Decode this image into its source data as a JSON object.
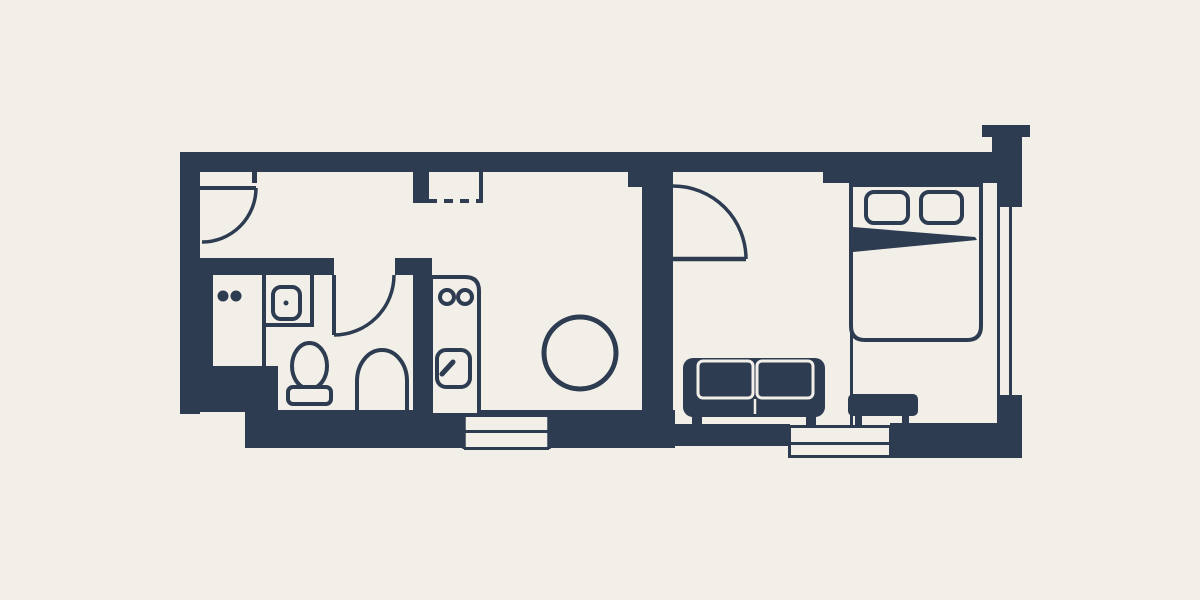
{
  "meta": {
    "title": "studio-apartment-floor-plan",
    "canvas": {
      "width": 1200,
      "height": 600
    }
  },
  "palette": {
    "background": "#f2efe9",
    "wall": "#2d3c50",
    "cream": "#f2efe9"
  },
  "rooms": [
    "entry-hall",
    "bathroom",
    "kitchen",
    "dining-area",
    "living-room",
    "bedroom"
  ],
  "floorplan": {
    "elements": [
      {
        "name": "top-wall",
        "kind": "rect",
        "x": 180,
        "y": 152,
        "w": 842,
        "h": 20,
        "fill": "wall"
      },
      {
        "name": "bedroom-top-wall",
        "kind": "rect",
        "x": 823,
        "y": 152,
        "w": 199,
        "h": 31,
        "fill": "wall"
      },
      {
        "name": "chimney-cap",
        "kind": "rect",
        "x": 982,
        "y": 125,
        "w": 48,
        "h": 12,
        "fill": "wall"
      },
      {
        "name": "chimney-stub",
        "kind": "rect",
        "x": 992,
        "y": 137,
        "w": 30,
        "h": 16,
        "fill": "wall"
      },
      {
        "name": "left-wall",
        "kind": "rect",
        "x": 180,
        "y": 152,
        "w": 20,
        "h": 262,
        "fill": "wall"
      },
      {
        "name": "bathroom-corner-block",
        "kind": "rect",
        "x": 198,
        "y": 366,
        "w": 80,
        "h": 46,
        "fill": "wall"
      },
      {
        "name": "bottom-wall-left",
        "kind": "rect",
        "x": 245,
        "y": 410,
        "w": 430,
        "h": 38,
        "fill": "wall"
      },
      {
        "name": "bottom-wall-living",
        "kind": "rect",
        "x": 660,
        "y": 424,
        "w": 130,
        "h": 22,
        "fill": "wall"
      },
      {
        "name": "bottom-wall-right",
        "kind": "rect",
        "x": 890,
        "y": 423,
        "w": 132,
        "h": 35,
        "fill": "wall"
      },
      {
        "name": "right-wall",
        "kind": "rect",
        "x": 997,
        "y": 152,
        "w": 25,
        "h": 306,
        "fill": "wall"
      },
      {
        "name": "bathroom-top-wall",
        "kind": "rect",
        "x": 198,
        "y": 258,
        "w": 136,
        "h": 17,
        "fill": "wall"
      },
      {
        "name": "bathroom-top-wall-right",
        "kind": "rect",
        "x": 395,
        "y": 258,
        "w": 37,
        "h": 17,
        "fill": "wall"
      },
      {
        "name": "bathroom-kitchen-wall",
        "kind": "rect",
        "x": 413,
        "y": 263,
        "w": 19,
        "h": 150,
        "fill": "wall"
      },
      {
        "name": "bathroom-left-strip",
        "kind": "rect",
        "x": 198,
        "y": 275,
        "w": 15,
        "h": 95,
        "fill": "wall"
      },
      {
        "name": "closet-side-wall",
        "kind": "rect",
        "x": 413,
        "y": 171,
        "w": 16,
        "h": 32,
        "fill": "wall"
      },
      {
        "name": "living-divider-flare",
        "kind": "rect",
        "x": 628,
        "y": 171,
        "w": 45,
        "h": 16,
        "fill": "wall"
      },
      {
        "name": "living-divider-wall",
        "kind": "rect",
        "x": 642,
        "y": 171,
        "w": 31,
        "h": 256,
        "fill": "wall"
      },
      {
        "name": "entry-door-jamb",
        "kind": "rect",
        "x": 252,
        "y": 171,
        "w": 5,
        "h": 12,
        "fill": "wall"
      },
      {
        "name": "kitchen-window-glass",
        "kind": "rect",
        "x": 464,
        "y": 417,
        "w": 85,
        "h": 30,
        "fill": "cream"
      },
      {
        "name": "kitchen-window-mid-line",
        "kind": "line",
        "x1": 464,
        "y1": 431.5,
        "x2": 549,
        "y2": 431.5,
        "stroke": "wall",
        "sw": 3
      },
      {
        "name": "kitchen-window-left-end",
        "kind": "line",
        "x1": 464,
        "y1": 412,
        "x2": 464,
        "y2": 449,
        "stroke": "wall",
        "sw": 3.5
      },
      {
        "name": "kitchen-window-right-end",
        "kind": "line",
        "x1": 549,
        "y1": 412,
        "x2": 549,
        "y2": 449,
        "stroke": "wall",
        "sw": 3.5
      },
      {
        "name": "kitchen-window-bottom-line",
        "kind": "line",
        "x1": 464,
        "y1": 448.5,
        "x2": 549,
        "y2": 448.5,
        "stroke": "wall",
        "sw": 3
      },
      {
        "name": "living-window-glass",
        "kind": "rect",
        "x": 789,
        "y": 427,
        "w": 102,
        "h": 29,
        "fill": "cream"
      },
      {
        "name": "living-window-top-line",
        "kind": "line",
        "x1": 788,
        "y1": 426.5,
        "x2": 892,
        "y2": 426.5,
        "stroke": "wall",
        "sw": 3
      },
      {
        "name": "living-window-mid-line",
        "kind": "line",
        "x1": 788,
        "y1": 443.5,
        "x2": 892,
        "y2": 443.5,
        "stroke": "wall",
        "sw": 3
      },
      {
        "name": "living-window-bottom-line",
        "kind": "line",
        "x1": 788,
        "y1": 456.5,
        "x2": 892,
        "y2": 456.5,
        "stroke": "wall",
        "sw": 3
      },
      {
        "name": "living-window-left-end",
        "kind": "line",
        "x1": 789.5,
        "y1": 425,
        "x2": 789.5,
        "y2": 458,
        "stroke": "wall",
        "sw": 3
      },
      {
        "name": "living-window-right-end",
        "kind": "line",
        "x1": 890.5,
        "y1": 425,
        "x2": 890.5,
        "y2": 458,
        "stroke": "wall",
        "sw": 3
      },
      {
        "name": "right-window-glass",
        "kind": "rect",
        "x": 1000,
        "y": 207,
        "w": 22,
        "h": 188,
        "fill": "cream"
      },
      {
        "name": "right-window-mid-line",
        "kind": "line",
        "x1": 1010.5,
        "y1": 207,
        "x2": 1010.5,
        "y2": 395,
        "stroke": "wall",
        "sw": 3
      },
      {
        "name": "entry-door-leaf",
        "kind": "line",
        "x1": 200,
        "y1": 188,
        "x2": 256,
        "y2": 188,
        "stroke": "wall",
        "sw": 4
      },
      {
        "name": "entry-door-arc",
        "kind": "path",
        "d": "M256,188 A54,54 0 0 1 202,242",
        "stroke": "wall",
        "sw": 3.5,
        "fill": "none"
      },
      {
        "name": "bathroom-door-leaf",
        "kind": "line",
        "x1": 334,
        "y1": 275,
        "x2": 334,
        "y2": 335,
        "stroke": "wall",
        "sw": 4
      },
      {
        "name": "bathroom-door-arc",
        "kind": "path",
        "d": "M394,275 A60,60 0 0 1 334,335",
        "stroke": "wall",
        "sw": 3.5,
        "fill": "none"
      },
      {
        "name": "living-door-leaf",
        "kind": "line",
        "x1": 673,
        "y1": 259,
        "x2": 746,
        "y2": 259,
        "stroke": "wall",
        "sw": 4.5
      },
      {
        "name": "living-door-arc",
        "kind": "path",
        "d": "M746,259 A73,73 0 0 0 673,186",
        "stroke": "wall",
        "sw": 3.5,
        "fill": "none"
      },
      {
        "name": "closet-right-line",
        "kind": "line",
        "x1": 481,
        "y1": 172,
        "x2": 481,
        "y2": 202,
        "stroke": "wall",
        "sw": 4
      },
      {
        "name": "closet-dashed-front",
        "kind": "line",
        "x1": 428,
        "y1": 201,
        "x2": 483,
        "y2": 201,
        "stroke": "wall",
        "sw": 4,
        "dash": "9 7"
      },
      {
        "name": "counter-burner-dot-1",
        "kind": "circle",
        "cx": 223,
        "cy": 296,
        "r": 5.5,
        "fill": "wall"
      },
      {
        "name": "counter-burner-dot-2",
        "kind": "circle",
        "cx": 236,
        "cy": 296,
        "r": 5.5,
        "fill": "wall"
      },
      {
        "name": "cabinet-divider-line",
        "kind": "line",
        "x1": 264,
        "y1": 275,
        "x2": 264,
        "y2": 368,
        "stroke": "wall",
        "sw": 4
      },
      {
        "name": "sink-counter-bottom-line",
        "kind": "line",
        "x1": 262,
        "y1": 325,
        "x2": 314,
        "y2": 325,
        "stroke": "wall",
        "sw": 4
      },
      {
        "name": "sink-counter-right-line",
        "kind": "line",
        "x1": 312,
        "y1": 262,
        "x2": 312,
        "y2": 327,
        "stroke": "wall",
        "sw": 4
      },
      {
        "name": "bathroom-sink-basin",
        "kind": "rect",
        "x": 273,
        "y": 287,
        "w": 27,
        "h": 32,
        "rx": 8,
        "stroke": "wall",
        "sw": 4,
        "fill": "cream"
      },
      {
        "name": "bathroom-sink-drain",
        "kind": "circle",
        "cx": 286,
        "cy": 303,
        "r": 2.5,
        "fill": "wall"
      },
      {
        "name": "toilet-bowl",
        "kind": "ellipse",
        "cx": 309.5,
        "cy": 366,
        "rx": 17.5,
        "ry": 23,
        "stroke": "wall",
        "sw": 4,
        "fill": "cream"
      },
      {
        "name": "toilet-tank",
        "kind": "rect",
        "x": 288,
        "y": 387,
        "w": 43,
        "h": 17,
        "rx": 5,
        "stroke": "wall",
        "sw": 4,
        "fill": "cream"
      },
      {
        "name": "shower-arch",
        "kind": "path",
        "d": "M357,411 L357,381 A25,31 0 0 1 407,381 L407,411",
        "stroke": "wall",
        "sw": 4,
        "fill": "none"
      },
      {
        "name": "kitchen-unit-outline",
        "kind": "path",
        "d": "M431,413 L431,277 L465,277 Q479,277 479,291 L479,413",
        "stroke": "wall",
        "sw": 4,
        "fill": "cream"
      },
      {
        "name": "kitchen-burner-1",
        "kind": "circle",
        "cx": 447,
        "cy": 297,
        "r": 7,
        "stroke": "wall",
        "sw": 4,
        "fill": "none"
      },
      {
        "name": "kitchen-burner-2",
        "kind": "circle",
        "cx": 465,
        "cy": 297,
        "r": 7,
        "stroke": "wall",
        "sw": 4,
        "fill": "none"
      },
      {
        "name": "kitchen-sink-square",
        "kind": "rect",
        "x": 437,
        "y": 350,
        "w": 33,
        "h": 37,
        "rx": 9,
        "stroke": "wall",
        "sw": 4,
        "fill": "cream"
      },
      {
        "name": "kitchen-faucet-handle",
        "kind": "line",
        "x1": 442,
        "y1": 374,
        "x2": 453,
        "y2": 362,
        "stroke": "wall",
        "sw": 5,
        "cap": "round"
      },
      {
        "name": "dining-table",
        "kind": "circle",
        "cx": 580,
        "cy": 353,
        "r": 36,
        "stroke": "wall",
        "sw": 5,
        "fill": "cream"
      },
      {
        "name": "bedroom-partition-line",
        "kind": "line",
        "x1": 851.5,
        "y1": 183,
        "x2": 851.5,
        "y2": 427,
        "stroke": "wall",
        "sw": 3
      },
      {
        "name": "bed-outline",
        "kind": "path",
        "d": "M851,185 L981,185 L981,326 Q981,340 967,340 L865,340 Q851,340 851,326 Z",
        "stroke": "wall",
        "sw": 4,
        "fill": "cream"
      },
      {
        "name": "bed-pillow-1",
        "kind": "rect",
        "x": 866,
        "y": 192,
        "w": 42,
        "h": 31,
        "rx": 8,
        "stroke": "wall",
        "sw": 4,
        "fill": "cream"
      },
      {
        "name": "bed-pillow-2",
        "kind": "rect",
        "x": 921,
        "y": 192,
        "w": 41,
        "h": 31,
        "rx": 8,
        "stroke": "wall",
        "sw": 4,
        "fill": "cream"
      },
      {
        "name": "bed-blanket-wedge",
        "kind": "polygon",
        "points": "853,227 975,237 977,240 853,252",
        "fill": "wall"
      },
      {
        "name": "sofa-body",
        "kind": "rect",
        "x": 683,
        "y": 358,
        "w": 142,
        "h": 59,
        "rx": 10,
        "fill": "wall"
      },
      {
        "name": "sofa-cushion-1",
        "kind": "rect",
        "x": 698,
        "y": 361,
        "w": 55,
        "h": 37,
        "rx": 5,
        "stroke": "cream",
        "sw": 3,
        "fill": "none"
      },
      {
        "name": "sofa-cushion-2",
        "kind": "rect",
        "x": 757,
        "y": 361,
        "w": 56,
        "h": 37,
        "rx": 5,
        "stroke": "cream",
        "sw": 3,
        "fill": "none"
      },
      {
        "name": "sofa-seat-split-line",
        "kind": "line",
        "x1": 755,
        "y1": 399,
        "x2": 755,
        "y2": 414,
        "stroke": "cream",
        "sw": 2.5
      },
      {
        "name": "sofa-foot-1",
        "kind": "rect",
        "x": 692,
        "y": 417,
        "w": 10,
        "h": 11,
        "fill": "wall"
      },
      {
        "name": "sofa-foot-2",
        "kind": "rect",
        "x": 806,
        "y": 417,
        "w": 10,
        "h": 11,
        "fill": "wall"
      },
      {
        "name": "ottoman-body",
        "kind": "rect",
        "x": 848,
        "y": 394,
        "w": 70,
        "h": 22,
        "rx": 5,
        "fill": "wall"
      },
      {
        "name": "ottoman-leg-1",
        "kind": "rect",
        "x": 855,
        "y": 416,
        "w": 7,
        "h": 12,
        "fill": "wall"
      },
      {
        "name": "ottoman-leg-2",
        "kind": "rect",
        "x": 902,
        "y": 416,
        "w": 7,
        "h": 12,
        "fill": "wall"
      }
    ]
  }
}
